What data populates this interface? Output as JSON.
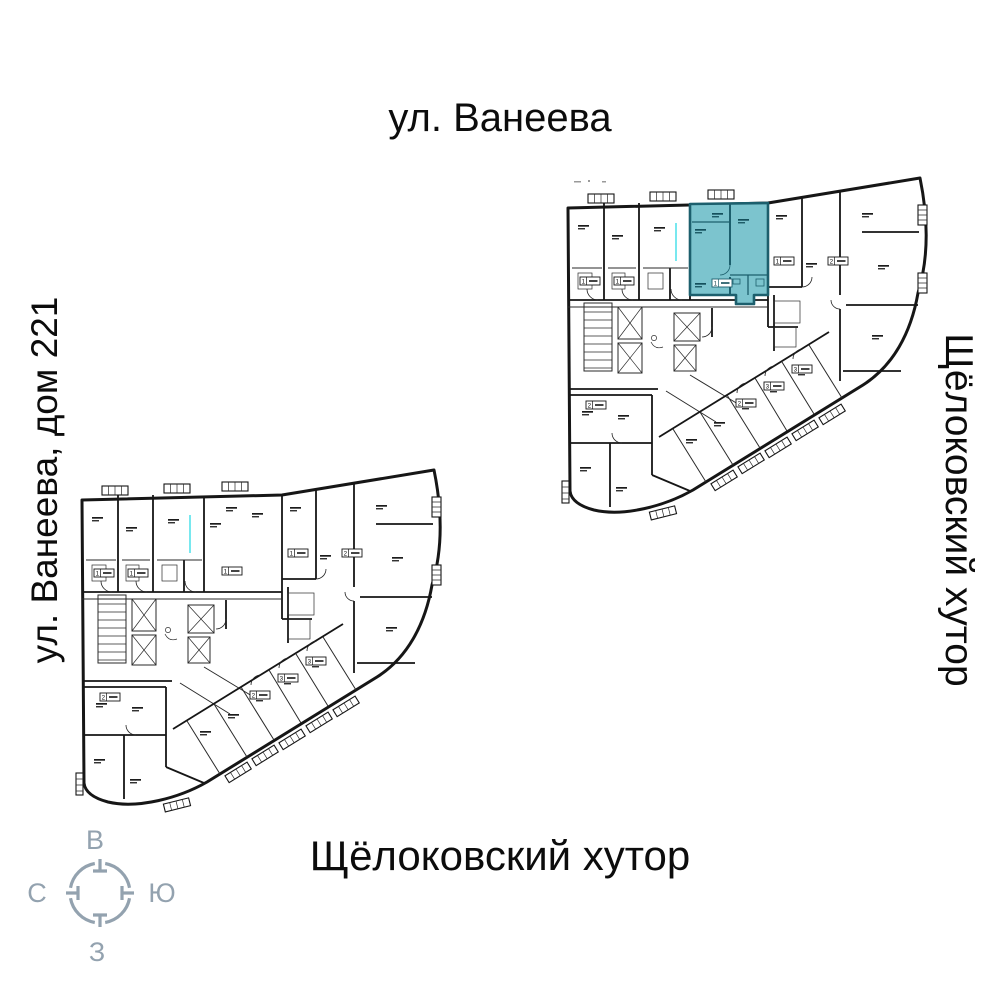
{
  "labels": {
    "street_top": "ул. Ванеева",
    "street_left": "ул. Ванеева, дом 221",
    "street_right": "Щёлоковский хутор",
    "street_bottom": "Щёлоковский хутор"
  },
  "compass": {
    "top": "В",
    "right": "Ю",
    "bottom": "З",
    "left": "С"
  },
  "plans": {
    "upper_highlight": {
      "rooms_badge": "1"
    },
    "badge_digits": [
      "1",
      "1",
      "1",
      "1",
      "1",
      "2",
      "3",
      "3",
      "2",
      "2"
    ]
  },
  "colors": {
    "highlight_fill": "#7cc4ce",
    "highlight_wall": "#1c5f6d",
    "wall": "#161616",
    "compass": "#93a2af",
    "artifact_cyan": "#3ddde8"
  }
}
